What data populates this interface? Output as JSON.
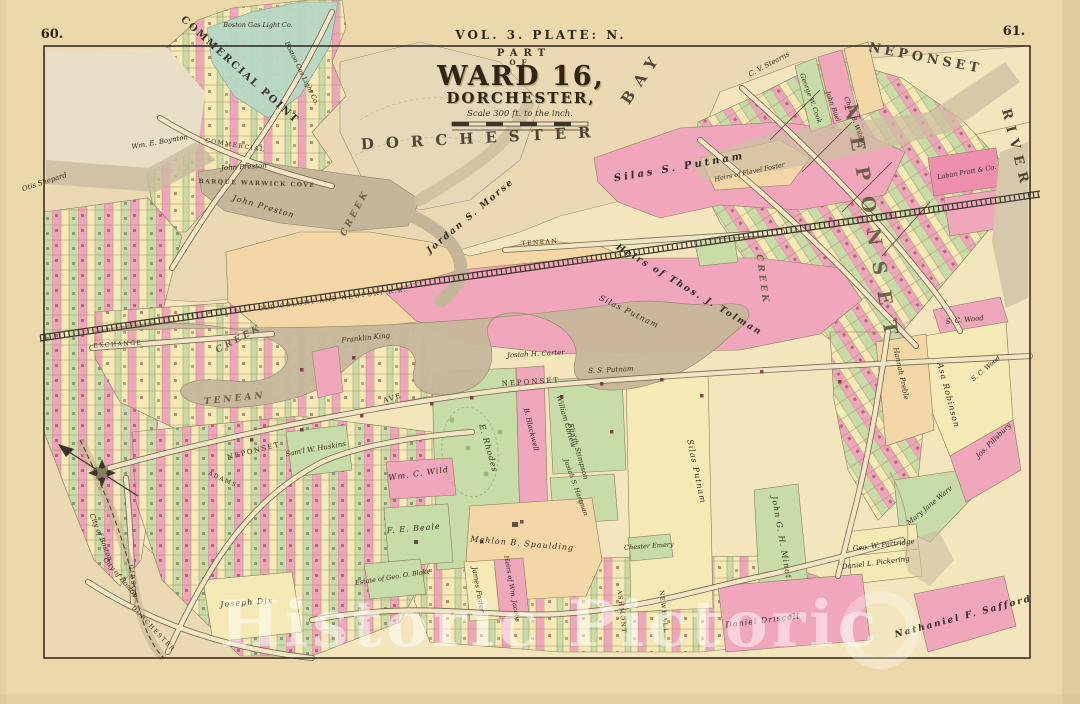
{
  "page": {
    "number_left": "60.",
    "number_right": "61.",
    "plate": "VOL. 3. PLATE: N."
  },
  "title": {
    "part": "PART",
    "of": "OF",
    "ward": "WARD 16,",
    "city": "DORCHESTER,",
    "scale_note": "Scale 300 ft. to the inch."
  },
  "geo": {
    "commercial_point": "COMMERCIAL POINT",
    "dorchester": "DORCHESTER",
    "bay": "BAY",
    "neponset": "NEPONSET",
    "river": "RIVER",
    "neponset_village": "NEPONSET",
    "tenean": "TENEAN",
    "creek": "CREEK",
    "barque_warwick_cove": "BARQUE WARWICK COVE"
  },
  "streets": {
    "commercial": "COMMERCIAL",
    "exchange": "EXCHANGE",
    "railroad": "OLD COLONY AND NEWPORT R.R.",
    "neponset_ave": "NEPONSET",
    "ave": "AVE",
    "adams": "ADAMS",
    "gibson": "GIBSON",
    "dorchester": "DORCHESTER",
    "tenean": "TENEAN",
    "ashmont": "ASHMONT",
    "newhall": "NEWHALL"
  },
  "boundary": {
    "city_of_boston": "City of Boston"
  },
  "owners": {
    "gas": "Boston Gas Light Co.",
    "boynton": "Wm. E. Boynton",
    "shepard": "Otis Shepard",
    "preston": "John Preston",
    "morse": "Jordan S. Morse",
    "putnam_upper": "Silas S. Putnam",
    "tolman": "Heirs of Thos. J. Tolman",
    "foster_flavel": "Heirs of Flavel Foster",
    "stearns": "C. V. Stearns",
    "cook": "George W. Cook",
    "buel": "John Buel",
    "wilson": "Chas. B. Wilson",
    "pratt": "Laban Pratt & Co.",
    "wood": "S. C. Wood",
    "robinson": "Asa Robinson",
    "preble": "Hannah Preble",
    "pillsbury": "Jos. Pillsbury",
    "ware": "Mary Jane Ware",
    "king": "Franklin King",
    "carter": "Josiah H. Carter",
    "putnam_ss": "S. S. Putnam",
    "putnam_silas": "Silas Putnam",
    "rhodes": "E. Rhodes",
    "blackwell": "B. Blackwell",
    "corlew": "William Corlew",
    "stimpson": "Eliz'th Stimpson",
    "huskins": "Sam'l W. Huskins",
    "wild": "Wm. C. Wild",
    "beale": "F. E. Beale",
    "spaulding": "Mahlon B. Spaulding",
    "hartman": "Josiah S. Hartman",
    "foster_james": "James Foster",
    "jacobs": "Heirs of Wm. Jacobs",
    "blake": "Estate of Geo. O. Blake",
    "dix": "Joseph Dix",
    "emery": "Chester Emery",
    "minot": "John G. H. Minot",
    "partridge": "Geo. W. Partridge",
    "pickering": "Daniel L. Pickering",
    "safford": "Nathaniel F. Safford",
    "driscoll": "Daniel Driscoll"
  },
  "watermark": {
    "text": "Historic Pictoric"
  },
  "palette": {
    "paper": "#ecd9ab",
    "pink": "#f0a6bb",
    "green": "#c7dca6",
    "teal": "#b7d8c4",
    "yellow": "#f5e9b6",
    "peach": "#f4d7a7",
    "water_gray": "#c6b89b",
    "ink": "#33291e",
    "watermark": "#ffffff"
  }
}
